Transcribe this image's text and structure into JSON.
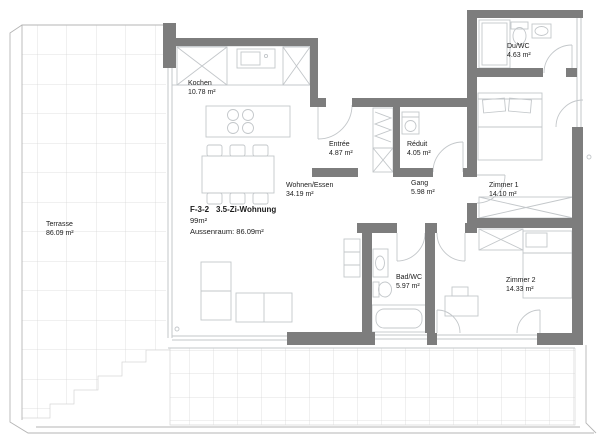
{
  "plan": {
    "unit": {
      "code": "F-3-2",
      "type": "3.5-Zi-Wohnung",
      "living_area": "99m²",
      "outdoor": "Aussenraum: 86.09m²"
    },
    "rooms": {
      "terrasse": {
        "name": "Terrasse",
        "area": "86.09 m²"
      },
      "kochen": {
        "name": "Kochen",
        "area": "10.78 m²"
      },
      "wohnen_essen": {
        "name": "Wohnen/Essen",
        "area": "34.19 m²"
      },
      "entree": {
        "name": "Entrée",
        "area": "4.87 m²"
      },
      "reduit": {
        "name": "Réduit",
        "area": "4.05 m²"
      },
      "gang": {
        "name": "Gang",
        "area": "5.98 m²"
      },
      "du_wc": {
        "name": "Du/WC",
        "area": "4.63 m²"
      },
      "bad_wc": {
        "name": "Bad/WC",
        "area": "5.97 m²"
      },
      "zimmer1": {
        "name": "Zimmer 1",
        "area": "14.10 m²"
      },
      "zimmer2": {
        "name": "Zimmer 2",
        "area": "14.33 m²"
      }
    },
    "colors": {
      "wall": "#7d7d7d",
      "furniture_line": "#c3c7ca",
      "grid_line": "#d6d6d6",
      "text": "#1b1b1b",
      "background": "#ffffff"
    }
  }
}
